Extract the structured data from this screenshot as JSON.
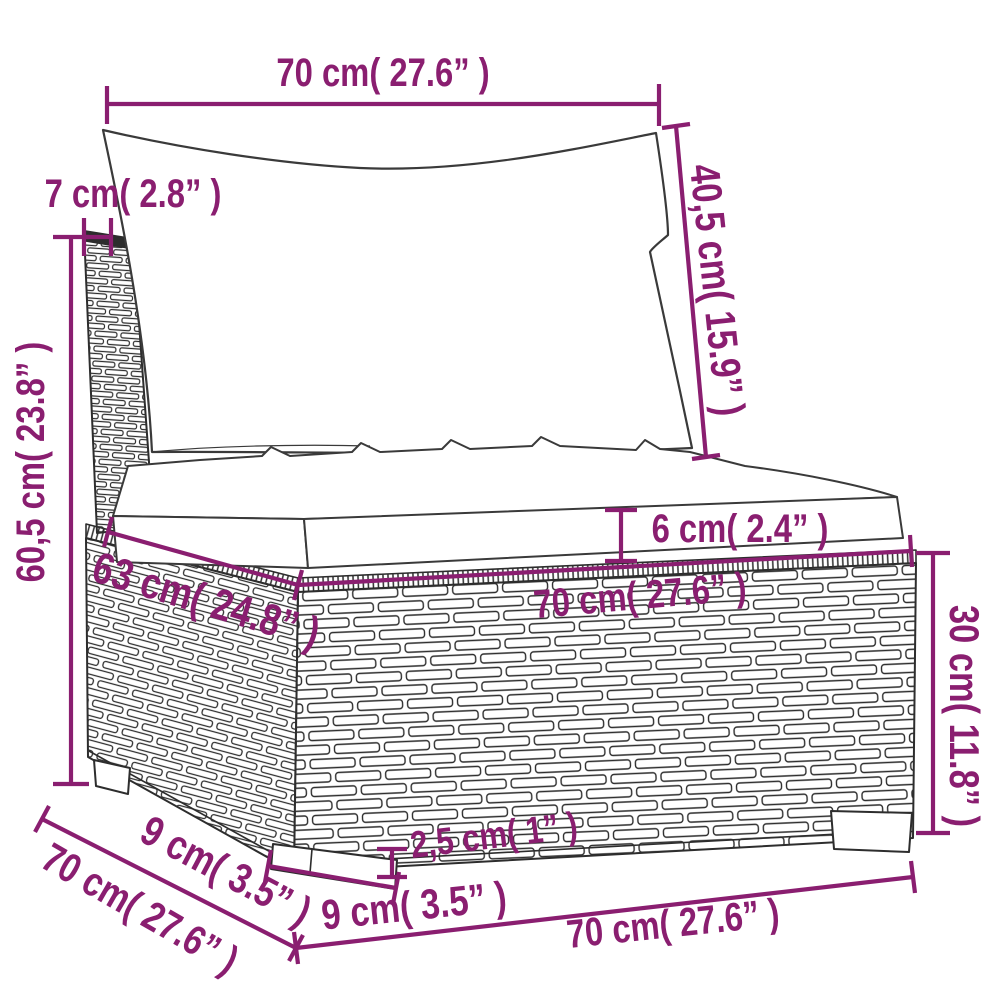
{
  "diagram": {
    "kind": "product-dimension-diagram",
    "accent_color": "#8a1e70",
    "line_color": "#2d2d2d",
    "dimensions": {
      "back_cushion_width": "70 cm( 27.6” )",
      "back_cushion_height": "40,5 cm( 15.9” )",
      "back_frame_thickness": "7 cm( 2.8” )",
      "back_total_height": "60,5 cm( 23.8” )",
      "seat_cushion_thickness": "6 cm( 2.4” )",
      "seat_depth": "63 cm( 24.8” )",
      "seat_width": "70 cm( 27.6” )",
      "base_height": "30 cm( 11.8” )",
      "foot_height": "2,5 cm( 1” )",
      "foot_depth": "9 cm( 3.5” )",
      "total_depth": "70 cm( 27.6” )",
      "foot_width": "9 cm( 3.5” )",
      "base_width": "70 cm( 27.6” )"
    }
  }
}
